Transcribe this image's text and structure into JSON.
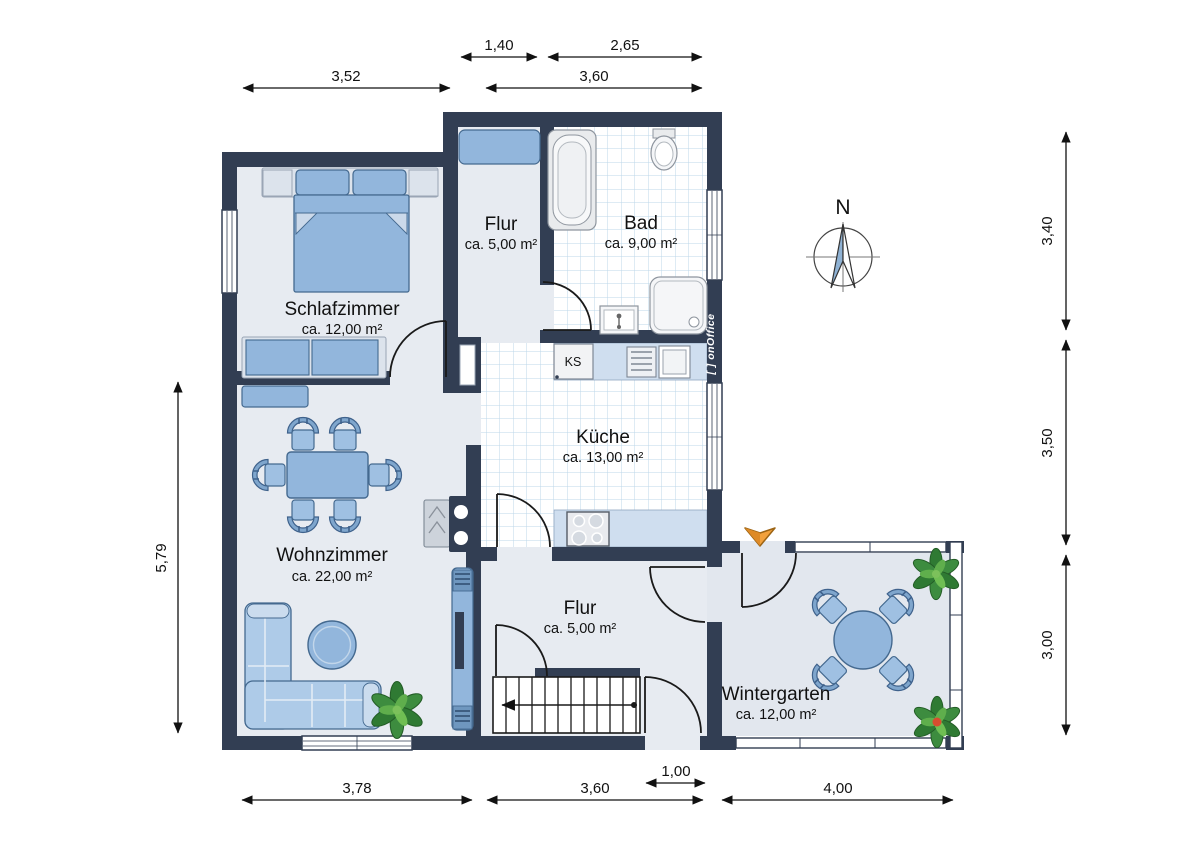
{
  "plan_title": "floor-plan",
  "rooms": {
    "schlafzimmer": {
      "name": "Schlafzimmer",
      "area": "ca. 12,00 m²"
    },
    "flur_top": {
      "name": "Flur",
      "area": "ca. 5,00 m²"
    },
    "bad": {
      "name": "Bad",
      "area": "ca. 9,00 m²"
    },
    "kueche": {
      "name": "Küche",
      "area": "ca. 13,00 m²"
    },
    "wohnzimmer": {
      "name": "Wohnzimmer",
      "area": "ca. 22,00 m²"
    },
    "flur_bottom": {
      "name": "Flur",
      "area": "ca. 5,00 m²"
    },
    "wintergarten": {
      "name": "Wintergarten",
      "area": "ca. 12,00 m²"
    }
  },
  "dims": {
    "top_inner_left": "1,40",
    "top_inner_right": "2,65",
    "top_left": "3,52",
    "top_right": "3,60",
    "bottom_left": "3,78",
    "bottom_mid": "3,60",
    "bottom_small": "1,00",
    "bottom_right": "4,00",
    "left_side": "5,79",
    "right_top": "3,40",
    "right_mid": "3,50",
    "right_bottom": "3,00"
  },
  "labels": {
    "fridge": "KS",
    "north": "N",
    "watermark": "[ ] onOffice"
  },
  "colors": {
    "wall": "#323E53",
    "floor": "#E7EBF1",
    "wintergarten_floor": "#E2E7EE",
    "tile_line": "#BCD7EA",
    "furniture_fill": "#92B6DC",
    "furniture_stroke": "#44698F",
    "light_furniture": "#DCE3EC",
    "counter": "#CFDEEF",
    "entrance_arrow": "#F2A13C",
    "plant": "#3D8C3F"
  }
}
